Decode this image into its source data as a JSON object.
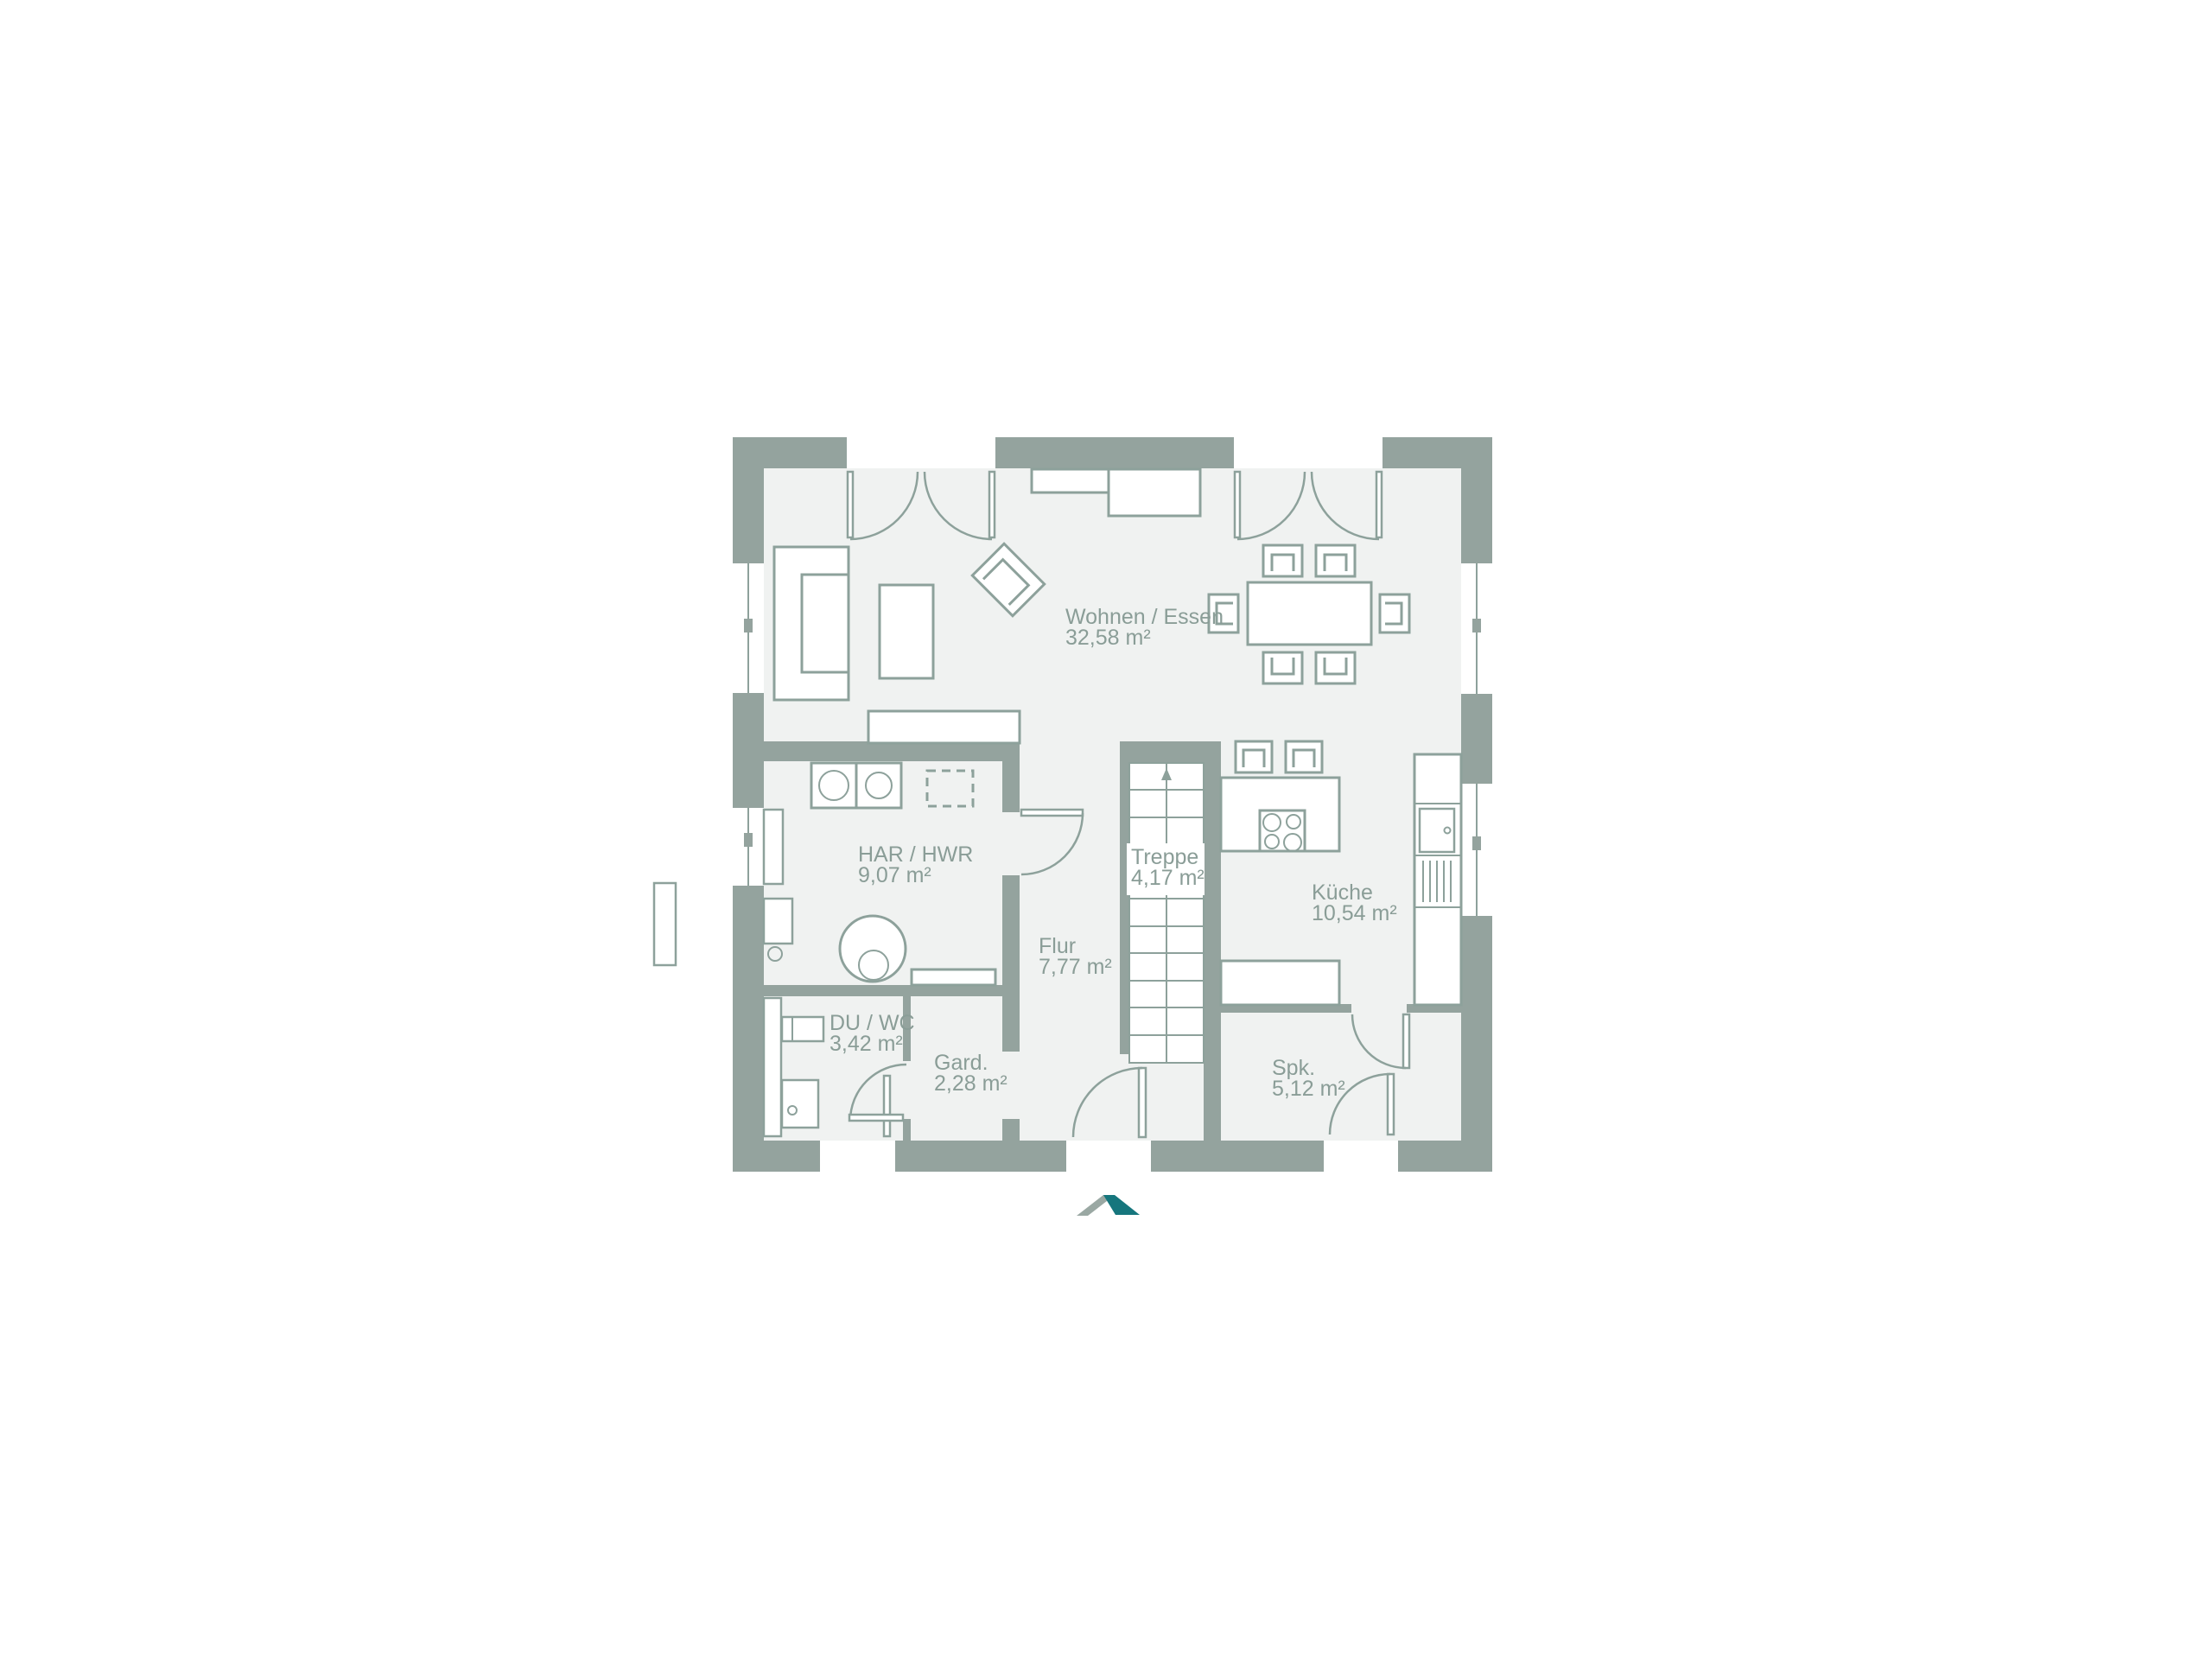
{
  "rooms": [
    {
      "id": "wohnen-essen",
      "label": "Wohnen / Essen",
      "area": "32,58 m²"
    },
    {
      "id": "har-hwr",
      "label": "HAR / HWR",
      "area": "9,07 m²"
    },
    {
      "id": "treppe",
      "label": "Treppe",
      "area": "4,17 m²"
    },
    {
      "id": "kueche",
      "label": "Küche",
      "area": "10,54 m²"
    },
    {
      "id": "flur",
      "label": "Flur",
      "area": "7,77 m²"
    },
    {
      "id": "du-wc",
      "label": "DU / WC",
      "area": "3,42 m²"
    },
    {
      "id": "gard",
      "label": "Gard.",
      "area": "2,28 m²"
    },
    {
      "id": "spk",
      "label": "Spk.",
      "area": "5,12 m²"
    }
  ],
  "logo": {
    "name": "roof-logo"
  },
  "colors": {
    "wall": "#94a39e",
    "floor": "#f0f2f1",
    "line": "#8da19b",
    "text": "#8a9d97",
    "logo_teal": "#16767d",
    "logo_gray": "#9aa8a3"
  }
}
